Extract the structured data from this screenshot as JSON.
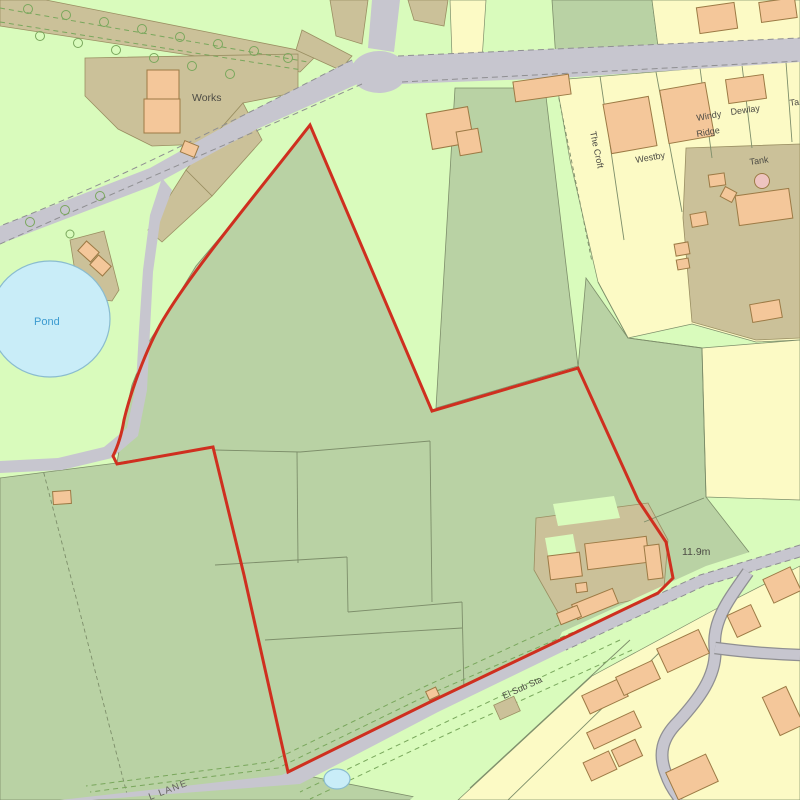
{
  "map": {
    "kind": "site-location-plan",
    "labels": {
      "works": "Works",
      "pond": "Pond",
      "the_croft": "The Croft",
      "westby": "Westby",
      "windy_ridge_1": "Windy",
      "windy_ridge_2": "Ridge",
      "dewlay": "Dewlay",
      "tank": "Tank",
      "tank_partial": "Ta",
      "spot_height": "11.9m",
      "el_sub_sta": "El Sub Sta",
      "lane": "L LANE"
    },
    "palette": {
      "background": "#d9fbbc",
      "field_green": "#b9d2a4",
      "cream": "#fcfac5",
      "tan": "#cbc199",
      "tan_line": "#9a8f62",
      "building_orange": "#f4c79a",
      "building_pink": "#eec4c0",
      "building_outline": "#9c7a45",
      "road_grey": "#c7c6cf",
      "road_casing": "#8f8f92",
      "water_fill": "#c9edf8",
      "water_stroke": "#8abccf",
      "water_text": "#3d9bd0",
      "boundary_red": "#cf2f1f",
      "label_color": "#4c4b44",
      "road_label": "#63625c",
      "field_line": "#7d8e6a",
      "tree_green": "#79a75c"
    }
  }
}
